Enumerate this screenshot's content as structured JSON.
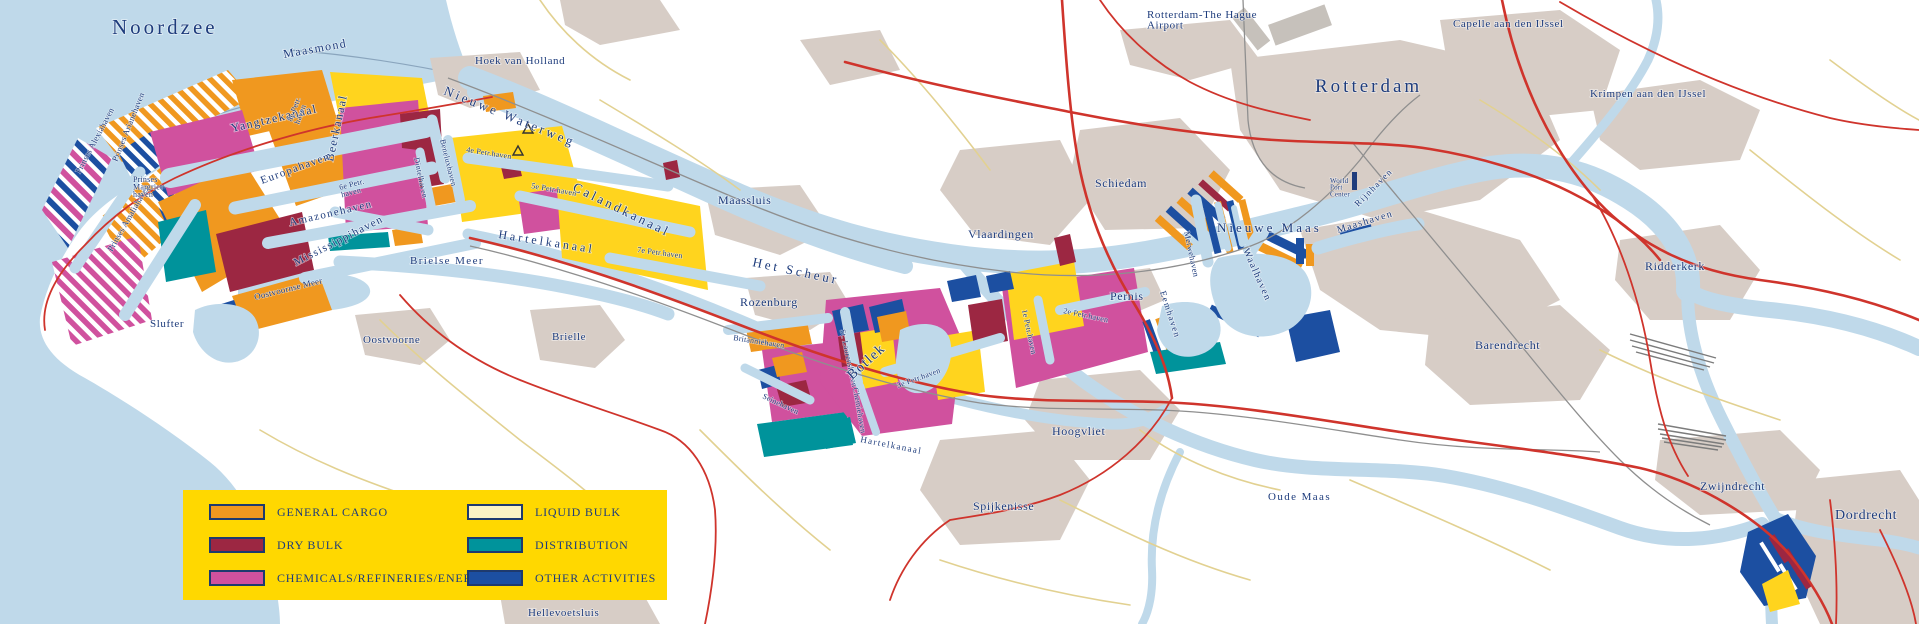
{
  "colors": {
    "water": "#bfd9ea",
    "land": "#ffffff",
    "urban": "#d7cdc6",
    "runway": "#c6c1bb",
    "road_major": "#cf342c",
    "road_minor": "#e2d191",
    "railway": "#8f8f8f",
    "label": "#1e3c7c",
    "legend_bg": "#ffd800",
    "general_cargo": "#f0981f",
    "dry_bulk": "#9c2742",
    "chemicals": "#d0519e",
    "liquid_bulk": "#ffd41e",
    "liquid_bulk_swatch": "#fbf3c4",
    "distribution": "#00939b",
    "other_activities": "#1c4fa1"
  },
  "legend": {
    "items": [
      {
        "label": "GENERAL CARGO",
        "color": "#f0981f"
      },
      {
        "label": "DRY BULK",
        "color": "#9c2742"
      },
      {
        "label": "CHEMICALS/REFINERIES/ENERGY",
        "color": "#d0519e"
      },
      {
        "label": "LIQUID BULK",
        "color": "#fbf3c4"
      },
      {
        "label": "DISTRIBUTION",
        "color": "#00939b"
      },
      {
        "label": "OTHER ACTIVITIES",
        "color": "#1c4fa1"
      }
    ]
  },
  "map_labels": [
    {
      "id": "noordzee",
      "t": "Noordzee",
      "x": 112,
      "y": 34,
      "r": 0,
      "s": 21,
      "c": "lg"
    },
    {
      "id": "maasmond",
      "t": "Maasmond",
      "x": 284,
      "y": 58,
      "r": -10,
      "s": 12,
      "c": "wtr"
    },
    {
      "id": "hoek-van-holland",
      "t": "Hoek van Holland",
      "x": 475,
      "y": 64,
      "r": 0,
      "s": 11,
      "c": ""
    },
    {
      "id": "yangtzekanaal",
      "t": "Yangtzekanaal",
      "x": 232,
      "y": 132,
      "r": -13,
      "s": 12,
      "c": "wtr"
    },
    {
      "id": "beerkanaal",
      "t": "Beerkanaal",
      "x": 333,
      "y": 162,
      "r": -78,
      "s": 12,
      "c": "wtr"
    },
    {
      "id": "europahaven",
      "t": "Europahaven",
      "x": 262,
      "y": 184,
      "r": -20,
      "s": 11,
      "c": "wtr"
    },
    {
      "id": "amazonehaven",
      "t": "Amazonehaven",
      "x": 290,
      "y": 226,
      "r": -13,
      "s": 11,
      "c": "wtr"
    },
    {
      "id": "mississippihaven",
      "t": "Mississippihaven",
      "x": 296,
      "y": 266,
      "r": -27,
      "s": 11,
      "c": "wtr"
    },
    {
      "id": "prinses-alexiahaven",
      "t": "Prinses Alexiahaven",
      "x": 80,
      "y": 174,
      "r": -62,
      "s": 8.5,
      "c": "hrb"
    },
    {
      "id": "prinses-arianehaven",
      "t": "Prinses Arianehaven",
      "x": 117,
      "y": 162,
      "r": -68,
      "s": 8.5,
      "c": "hrb"
    },
    {
      "id": "prinses-amaliahaven",
      "t": "Prinses Amaliahaven",
      "x": 112,
      "y": 252,
      "r": -60,
      "s": 8.5,
      "c": "hrb"
    },
    {
      "id": "prinses-margriethaven",
      "t": [
        "Prinses",
        "Margriet-",
        "haven"
      ],
      "x": 133,
      "y": 182,
      "r": 0,
      "s": 8,
      "c": "hrb"
    },
    {
      "id": "achtste-petr-haven",
      "t": [
        "8e Petr.",
        "haven"
      ],
      "x": 292,
      "y": 122,
      "r": -70,
      "s": 8,
      "c": "hrb"
    },
    {
      "id": "zesde-petr-haven",
      "t": [
        "6e Petr.",
        "haven"
      ],
      "x": 340,
      "y": 190,
      "r": -15,
      "s": 8,
      "c": "hrb"
    },
    {
      "id": "slufter",
      "t": "Slufter",
      "x": 150,
      "y": 327,
      "r": 0,
      "s": 11,
      "c": ""
    },
    {
      "id": "oostvoornse-meer",
      "t": "Oostvoornse Meer",
      "x": 255,
      "y": 300,
      "r": -14,
      "s": 9,
      "c": "hrb"
    },
    {
      "id": "brielse-meer",
      "t": "Brielse Meer",
      "x": 410,
      "y": 264,
      "r": 0,
      "s": 11,
      "c": "wtr"
    },
    {
      "id": "nieuwe-waterweg",
      "t": "Nieuwe Waterweg",
      "x": 443,
      "y": 94,
      "r": 22,
      "s": 13,
      "c": "lg"
    },
    {
      "id": "vierde-petr-haven",
      "t": "4e Petr.haven",
      "x": 466,
      "y": 152,
      "r": 9,
      "s": 8,
      "c": "hrb"
    },
    {
      "id": "vijfde-petr-haven",
      "t": "5e Petr.haven",
      "x": 531,
      "y": 188,
      "r": 10,
      "s": 8,
      "c": "hrb"
    },
    {
      "id": "calandkanaal",
      "t": "Calandkanaal",
      "x": 572,
      "y": 190,
      "r": 26,
      "s": 13,
      "c": "lg"
    },
    {
      "id": "dintelhaven",
      "t": "Dintelhaven",
      "x": 414,
      "y": 158,
      "r": 78,
      "s": 8,
      "c": "hrb"
    },
    {
      "id": "beneluxhaven",
      "t": "Beneluxhaven",
      "x": 440,
      "y": 140,
      "r": 76,
      "s": 8,
      "c": "hrb"
    },
    {
      "id": "het-scheur",
      "t": "Het Scheur",
      "x": 752,
      "y": 266,
      "r": 12,
      "s": 13,
      "c": "lg"
    },
    {
      "id": "maassluis",
      "t": "Maassluis",
      "x": 718,
      "y": 204,
      "r": 0,
      "s": 12,
      "c": ""
    },
    {
      "id": "rozenburg",
      "t": "Rozenburg",
      "x": 740,
      "y": 306,
      "r": 0,
      "s": 12,
      "c": ""
    },
    {
      "id": "zevende-petr-haven",
      "t": "7e Petr.haven",
      "x": 637,
      "y": 252,
      "r": 8,
      "s": 8,
      "c": "hrb"
    },
    {
      "id": "britanniehaven",
      "t": "Britanniëhaven",
      "x": 733,
      "y": 340,
      "r": 9,
      "s": 8,
      "c": "hrb"
    },
    {
      "id": "seinehaven",
      "t": "Seinehaven",
      "x": 762,
      "y": 398,
      "r": 25,
      "s": 8,
      "c": "hrb"
    },
    {
      "id": "st-laurenshaven",
      "t": "St. Laurenshaven",
      "x": 840,
      "y": 330,
      "r": 78,
      "s": 8,
      "c": "hrb"
    },
    {
      "id": "botlek",
      "t": "Botlek",
      "x": 852,
      "y": 380,
      "r": -42,
      "s": 14,
      "c": "wtr"
    },
    {
      "id": "chemiehaven",
      "t": "Chemiehaven",
      "x": 853,
      "y": 388,
      "r": 80,
      "s": 8,
      "c": "hrb"
    },
    {
      "id": "derde-petr-haven",
      "t": "3e Petr.haven",
      "x": 898,
      "y": 388,
      "r": -20,
      "s": 8,
      "c": "hrb"
    },
    {
      "id": "eerste-petr-haven",
      "t": "1e Petr.haven",
      "x": 1022,
      "y": 310,
      "r": 78,
      "s": 8,
      "c": "hrb"
    },
    {
      "id": "tweede-petr-haven",
      "t": "2e Petr.haven",
      "x": 1063,
      "y": 313,
      "r": 12,
      "s": 8,
      "c": "hrb"
    },
    {
      "id": "hartelkanaal-west",
      "t": "Hartelkanaal",
      "x": 498,
      "y": 238,
      "r": 9,
      "s": 12,
      "c": "lg"
    },
    {
      "id": "hartelkanaal-east",
      "t": "Hartelkanaal",
      "x": 860,
      "y": 442,
      "r": 11,
      "s": 9,
      "c": "wtr"
    },
    {
      "id": "vlaardingen",
      "t": "Vlaardingen",
      "x": 968,
      "y": 238,
      "r": 0,
      "s": 12,
      "c": ""
    },
    {
      "id": "schiedam",
      "t": "Schiedam",
      "x": 1095,
      "y": 187,
      "r": 0,
      "s": 12,
      "c": ""
    },
    {
      "id": "pernis",
      "t": "Pernis",
      "x": 1110,
      "y": 300,
      "r": 0,
      "s": 12,
      "c": ""
    },
    {
      "id": "hoogvliet",
      "t": "Hoogvliet",
      "x": 1052,
      "y": 435,
      "r": 0,
      "s": 12,
      "c": ""
    },
    {
      "id": "nieuwe-maas",
      "t": "Nieuwe Maas",
      "x": 1217,
      "y": 232,
      "r": 0,
      "s": 13,
      "c": "lg"
    },
    {
      "id": "merwehaven",
      "t": "Merwehaven",
      "x": 1184,
      "y": 232,
      "r": 78,
      "s": 8.5,
      "c": "hrb"
    },
    {
      "id": "waalhaven",
      "t": "Waalhaven",
      "x": 1243,
      "y": 250,
      "r": 66,
      "s": 10,
      "c": "wtr"
    },
    {
      "id": "eemhaven",
      "t": "Eemhaven",
      "x": 1160,
      "y": 292,
      "r": 72,
      "s": 9,
      "c": "wtr"
    },
    {
      "id": "maashaven",
      "t": "Maashaven",
      "x": 1338,
      "y": 233,
      "r": -17,
      "s": 10,
      "c": "wtr"
    },
    {
      "id": "rijnhaven",
      "t": "Rijnhaven",
      "x": 1358,
      "y": 207,
      "r": -45,
      "s": 9,
      "c": "wtr"
    },
    {
      "id": "world-port-center",
      "t": [
        "World",
        "Port",
        "Center"
      ],
      "x": 1330,
      "y": 183,
      "r": 0,
      "s": 7,
      "c": "hrb"
    },
    {
      "id": "rotterdam",
      "t": "Rotterdam",
      "x": 1315,
      "y": 92,
      "r": 0,
      "s": 19,
      "c": "lg"
    },
    {
      "id": "rotterdam-the-hague-airport",
      "t": [
        "Rotterdam-The Hague",
        "Airport"
      ],
      "x": 1147,
      "y": 18,
      "r": 0,
      "s": 11,
      "c": ""
    },
    {
      "id": "capelle-aan-den-ijssel",
      "t": "Capelle aan den IJssel",
      "x": 1453,
      "y": 27,
      "r": 0,
      "s": 11,
      "c": ""
    },
    {
      "id": "krimpen-aan-den-ijssel",
      "t": "Krimpen aan den IJssel",
      "x": 1590,
      "y": 97,
      "r": 0,
      "s": 11,
      "c": ""
    },
    {
      "id": "ridderkerk",
      "t": "Ridderkerk",
      "x": 1645,
      "y": 270,
      "r": 0,
      "s": 12,
      "c": ""
    },
    {
      "id": "barendrecht",
      "t": "Barendrecht",
      "x": 1475,
      "y": 349,
      "r": 0,
      "s": 12,
      "c": ""
    },
    {
      "id": "zwijndrecht",
      "t": "Zwijndrecht",
      "x": 1700,
      "y": 490,
      "r": 0,
      "s": 12,
      "c": ""
    },
    {
      "id": "dordrecht",
      "t": "Dordrecht",
      "x": 1835,
      "y": 519,
      "r": 0,
      "s": 14,
      "c": ""
    },
    {
      "id": "oude-maas",
      "t": "Oude Maas",
      "x": 1268,
      "y": 500,
      "r": 0,
      "s": 11,
      "c": "wtr"
    },
    {
      "id": "spijkenisse",
      "t": "Spijkenisse",
      "x": 973,
      "y": 510,
      "r": 0,
      "s": 12,
      "c": ""
    },
    {
      "id": "hellevoetsluis",
      "t": "Hellevoetsluis",
      "x": 528,
      "y": 616,
      "r": 0,
      "s": 11,
      "c": ""
    },
    {
      "id": "oostvoorne",
      "t": "Oostvoorne",
      "x": 363,
      "y": 343,
      "r": 0,
      "s": 11,
      "c": ""
    },
    {
      "id": "brielle",
      "t": "Brielle",
      "x": 552,
      "y": 340,
      "r": 0,
      "s": 11,
      "c": ""
    }
  ]
}
